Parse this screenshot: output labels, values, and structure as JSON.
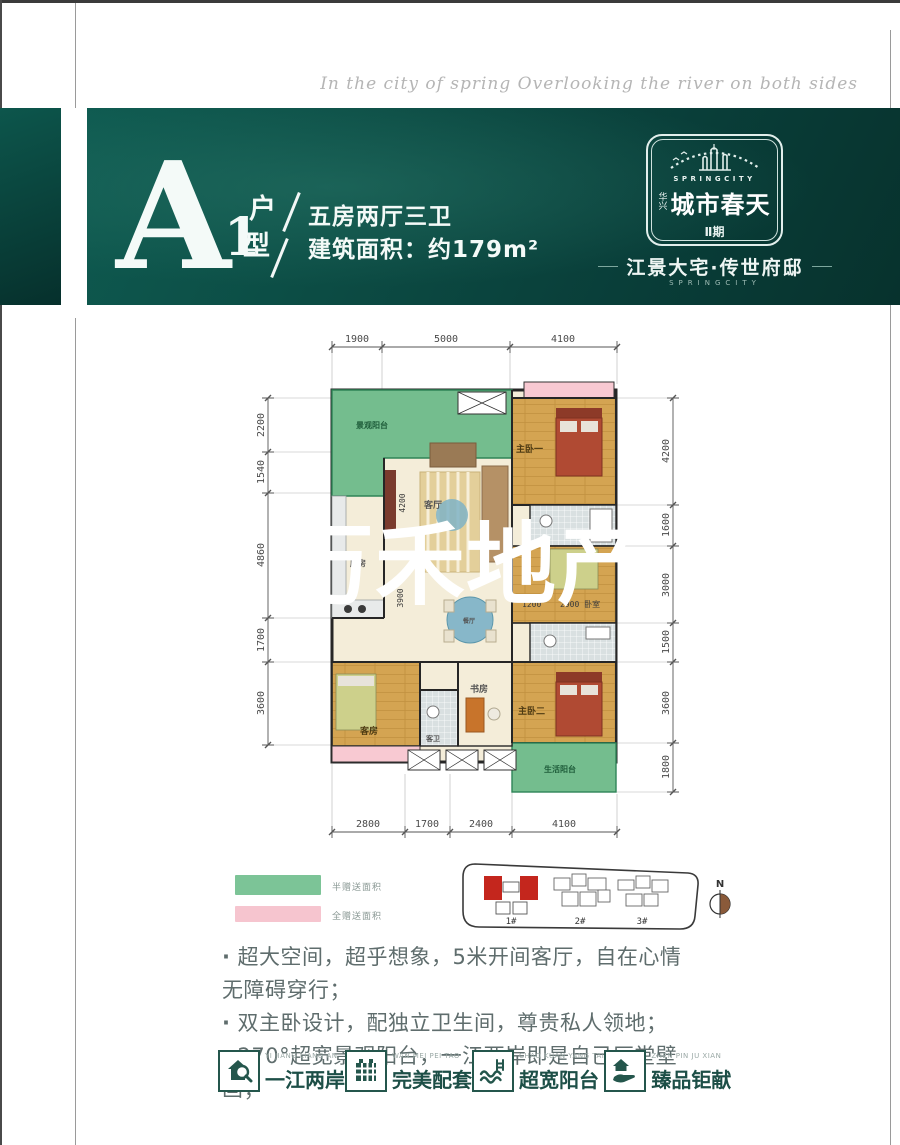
{
  "page": {
    "script_text": "In the city of spring Overlooking the river on both sides"
  },
  "header": {
    "unit_letter": "A",
    "unit_number": "1",
    "unit_hu": "户",
    "unit_xing": "型",
    "line1": "五房两厅三卫",
    "line2": "建筑面积：约179m²"
  },
  "logo": {
    "en": "SPRINGCITY",
    "brand_prefix": "华兴",
    "brand": "城市春天",
    "phase": "Ⅱ期",
    "tagline": "江景大宅·传世府邸",
    "tagline_en": "SPRINGCITY"
  },
  "floorplan": {
    "watermark": "万禾地产",
    "dims_top": [
      "1900",
      "5000",
      "4100"
    ],
    "dims_bottom": [
      "2800",
      "1700",
      "2400",
      "4100"
    ],
    "dims_left": [
      "2200",
      "1540",
      "4860",
      "1700",
      "3600"
    ],
    "dims_right": [
      "4200",
      "1600",
      "3000",
      "1500",
      "3600",
      "1800"
    ],
    "inner_dims": {
      "living_w": "4200",
      "dining": "3900",
      "bed_gap": "1200",
      "bed_w": "2900 卧室"
    },
    "rooms": {
      "view_balcony": "景观阳台",
      "master1": "主卧一",
      "living": "客厅",
      "dining": "餐厅",
      "kitchen": "厨房",
      "study": "书房",
      "guest": "客房",
      "guest_bath": "客卫",
      "master2": "主卧二",
      "life_balcony": "生活阳台"
    }
  },
  "legend": {
    "items": [
      {
        "label": "半赠送面积",
        "color": "#7cc497"
      },
      {
        "label": "全赠送面积",
        "color": "#f6c5cf"
      }
    ]
  },
  "siteplan": {
    "buildings": [
      "1#",
      "2#",
      "3#"
    ],
    "north": "N",
    "highlight_color": "#c4261d"
  },
  "bullets": [
    "超大空间，超乎想象，5米开间客厅，自在心情无障碍穿行；",
    "双主卧设计，配独立卫生间，尊贵私人领地；",
    "270°超宽景观阳台，一江两岸即是自己厅堂壁画；"
  ],
  "features": [
    {
      "en": "YI JIANG LIANG AN",
      "zh": "一江两岸"
    },
    {
      "en": "WAN MEI PEI TAO",
      "zh": "完美配套"
    },
    {
      "en": "CHAO KUAN YANG TAI",
      "zh": "超宽阳台"
    },
    {
      "en": "ZHEN PIN JU XIAN",
      "zh": "臻品钜献"
    }
  ],
  "colors": {
    "banner_teal": "#0c4c44",
    "feature_teal": "#1d4f47",
    "wood": "#d4a452",
    "balcony_green": "#74bd8e",
    "gift_pink": "#f8c9d2"
  }
}
